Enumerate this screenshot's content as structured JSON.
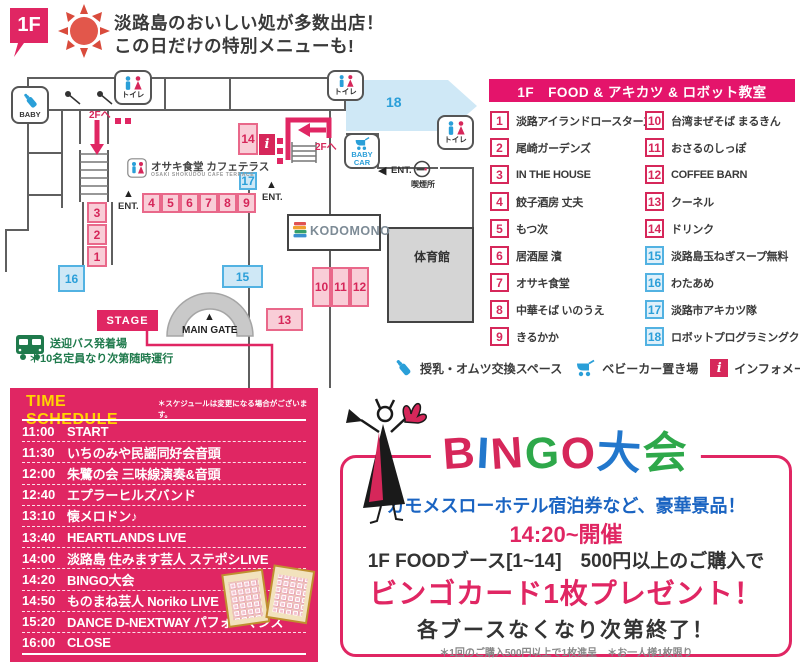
{
  "colors": {
    "pink_main": "#e02663",
    "crimson": "#d6275a",
    "legend_header_pink": "#e4146b",
    "booth_pink_fill": "#f9cdd7",
    "booth_pink_border": "#e9688a",
    "booth_blue_fill": "#cfe8f6",
    "booth_blue_border": "#52b2e2",
    "blue_text": "#2b9fd9",
    "bingo_blue": "#2277cc",
    "bingo_green": "#2ea84a",
    "bus_green": "#1f7a4c",
    "schedule_yellow": "#ffd400",
    "dark_text": "#3a3a3a",
    "wall_gray": "#5f5f5f",
    "gym_fill": "#d5d5d5"
  },
  "header": {
    "floor_badge": "1F",
    "title_line1": "淡路島のおいしい処が多数出店！",
    "title_line2": "この日だけの特別メニューも!"
  },
  "map": {
    "booths": [
      "1",
      "2",
      "3",
      "4",
      "5",
      "6",
      "7",
      "8",
      "9",
      "10",
      "11",
      "12",
      "13",
      "14",
      "15",
      "16",
      "17",
      "18"
    ],
    "labels": {
      "toilet": "トイレ",
      "baby": "BABY",
      "baby_car": "BABY CAR",
      "ent": "ENT.",
      "to_2f": "2Fへ",
      "smoking": "喫煙所",
      "gym": "体育館",
      "main_gate": "MAIN GATE",
      "stage": "STAGE",
      "kodomono": "KODOMONO",
      "osaki": "オサキ食堂 カフェテラス",
      "osaki_sub": "OSAKI SHOKUDOU CAFE TERRACE",
      "bus_line1": "送迎バス発着場",
      "bus_line2": "＊10名定員なり次第随時運行",
      "info_glyph": "i"
    },
    "icons": {
      "up_triangle": "▲",
      "left_triangle": "◀"
    }
  },
  "legend": {
    "header": "1F　FOOD & アキカツ & ロボット教室",
    "items": [
      {
        "num": "1",
        "label": "淡路アイランドロースターズ",
        "color": "pink"
      },
      {
        "num": "2",
        "label": "尾崎ガーデンズ",
        "color": "pink"
      },
      {
        "num": "3",
        "label": "IN THE HOUSE",
        "color": "pink"
      },
      {
        "num": "4",
        "label": "餃子酒房 丈夫",
        "color": "pink"
      },
      {
        "num": "5",
        "label": "もつ次",
        "color": "pink"
      },
      {
        "num": "6",
        "label": "居酒屋 濱",
        "color": "pink"
      },
      {
        "num": "7",
        "label": "オサキ食堂",
        "color": "pink"
      },
      {
        "num": "8",
        "label": "中華そば いのうえ",
        "color": "pink"
      },
      {
        "num": "9",
        "label": "きるかか",
        "color": "pink"
      },
      {
        "num": "10",
        "label": "台湾まぜそば まるきん",
        "color": "pink"
      },
      {
        "num": "11",
        "label": "おさるのしっぽ",
        "color": "pink"
      },
      {
        "num": "12",
        "label": "COFFEE BARN",
        "color": "pink"
      },
      {
        "num": "13",
        "label": "クーネル",
        "color": "pink"
      },
      {
        "num": "14",
        "label": "ドリンク",
        "color": "pink"
      },
      {
        "num": "15",
        "label": "淡路島玉ねぎスープ無料",
        "color": "blue"
      },
      {
        "num": "16",
        "label": "わたあめ",
        "color": "blue"
      },
      {
        "num": "17",
        "label": "淡路市アキカツ隊",
        "color": "blue"
      },
      {
        "num": "18",
        "label": "ロボットプログラミングクラブ",
        "color": "blue"
      }
    ],
    "facilities": [
      {
        "icon": "baby-bottle",
        "label": "授乳・オムツ交換スペース"
      },
      {
        "icon": "stroller",
        "label": "ベビーカー置き場"
      },
      {
        "icon": "info",
        "label": "インフォメーション"
      }
    ]
  },
  "schedule": {
    "title": "TIME SCHEDULE",
    "note": "＊スケジュールは変更になる場合がございます。",
    "rows": [
      {
        "time": "11:00",
        "event": "START"
      },
      {
        "time": "11:30",
        "event": "いちのみや民謡同好会音頭"
      },
      {
        "time": "12:00",
        "event": "朱鷺の会 三味線演奏&音頭"
      },
      {
        "time": "12:40",
        "event": "エプラーヒルズバンド"
      },
      {
        "time": "13:10",
        "event": "懐メロドン♪"
      },
      {
        "time": "13:40",
        "event": "HEARTLANDS LIVE"
      },
      {
        "time": "14:00",
        "event": "淡路島 住みます芸人 ステポシLIVE"
      },
      {
        "time": "14:20",
        "event": "BINGO大会"
      },
      {
        "time": "14:50",
        "event": "ものまね芸人 Noriko LIVE"
      },
      {
        "time": "15:20",
        "event": "DANCE D-NEXTWAY パフォーマンス"
      },
      {
        "time": "16:00",
        "event": "CLOSE"
      }
    ]
  },
  "bingo": {
    "title_chars": [
      {
        "ch": "B"
      },
      {
        "ch": "I"
      },
      {
        "ch": "N"
      },
      {
        "ch": "G"
      },
      {
        "ch": "O"
      },
      {
        "ch": "大"
      },
      {
        "ch": "会"
      }
    ],
    "prize_line": "カモメスローホテル宿泊券など、豪華景品！",
    "time_line": "14:20~開催",
    "cond_line": "1F FOODブース[1~14]　500円以上のご購入で",
    "present_line": "ビンゴカード1枚プレゼント！",
    "end_line": "各ブースなくなり次第終了！",
    "note_line": "＊1回のご購入500円以上で1枚進呈　＊お一人様1枚限り"
  }
}
